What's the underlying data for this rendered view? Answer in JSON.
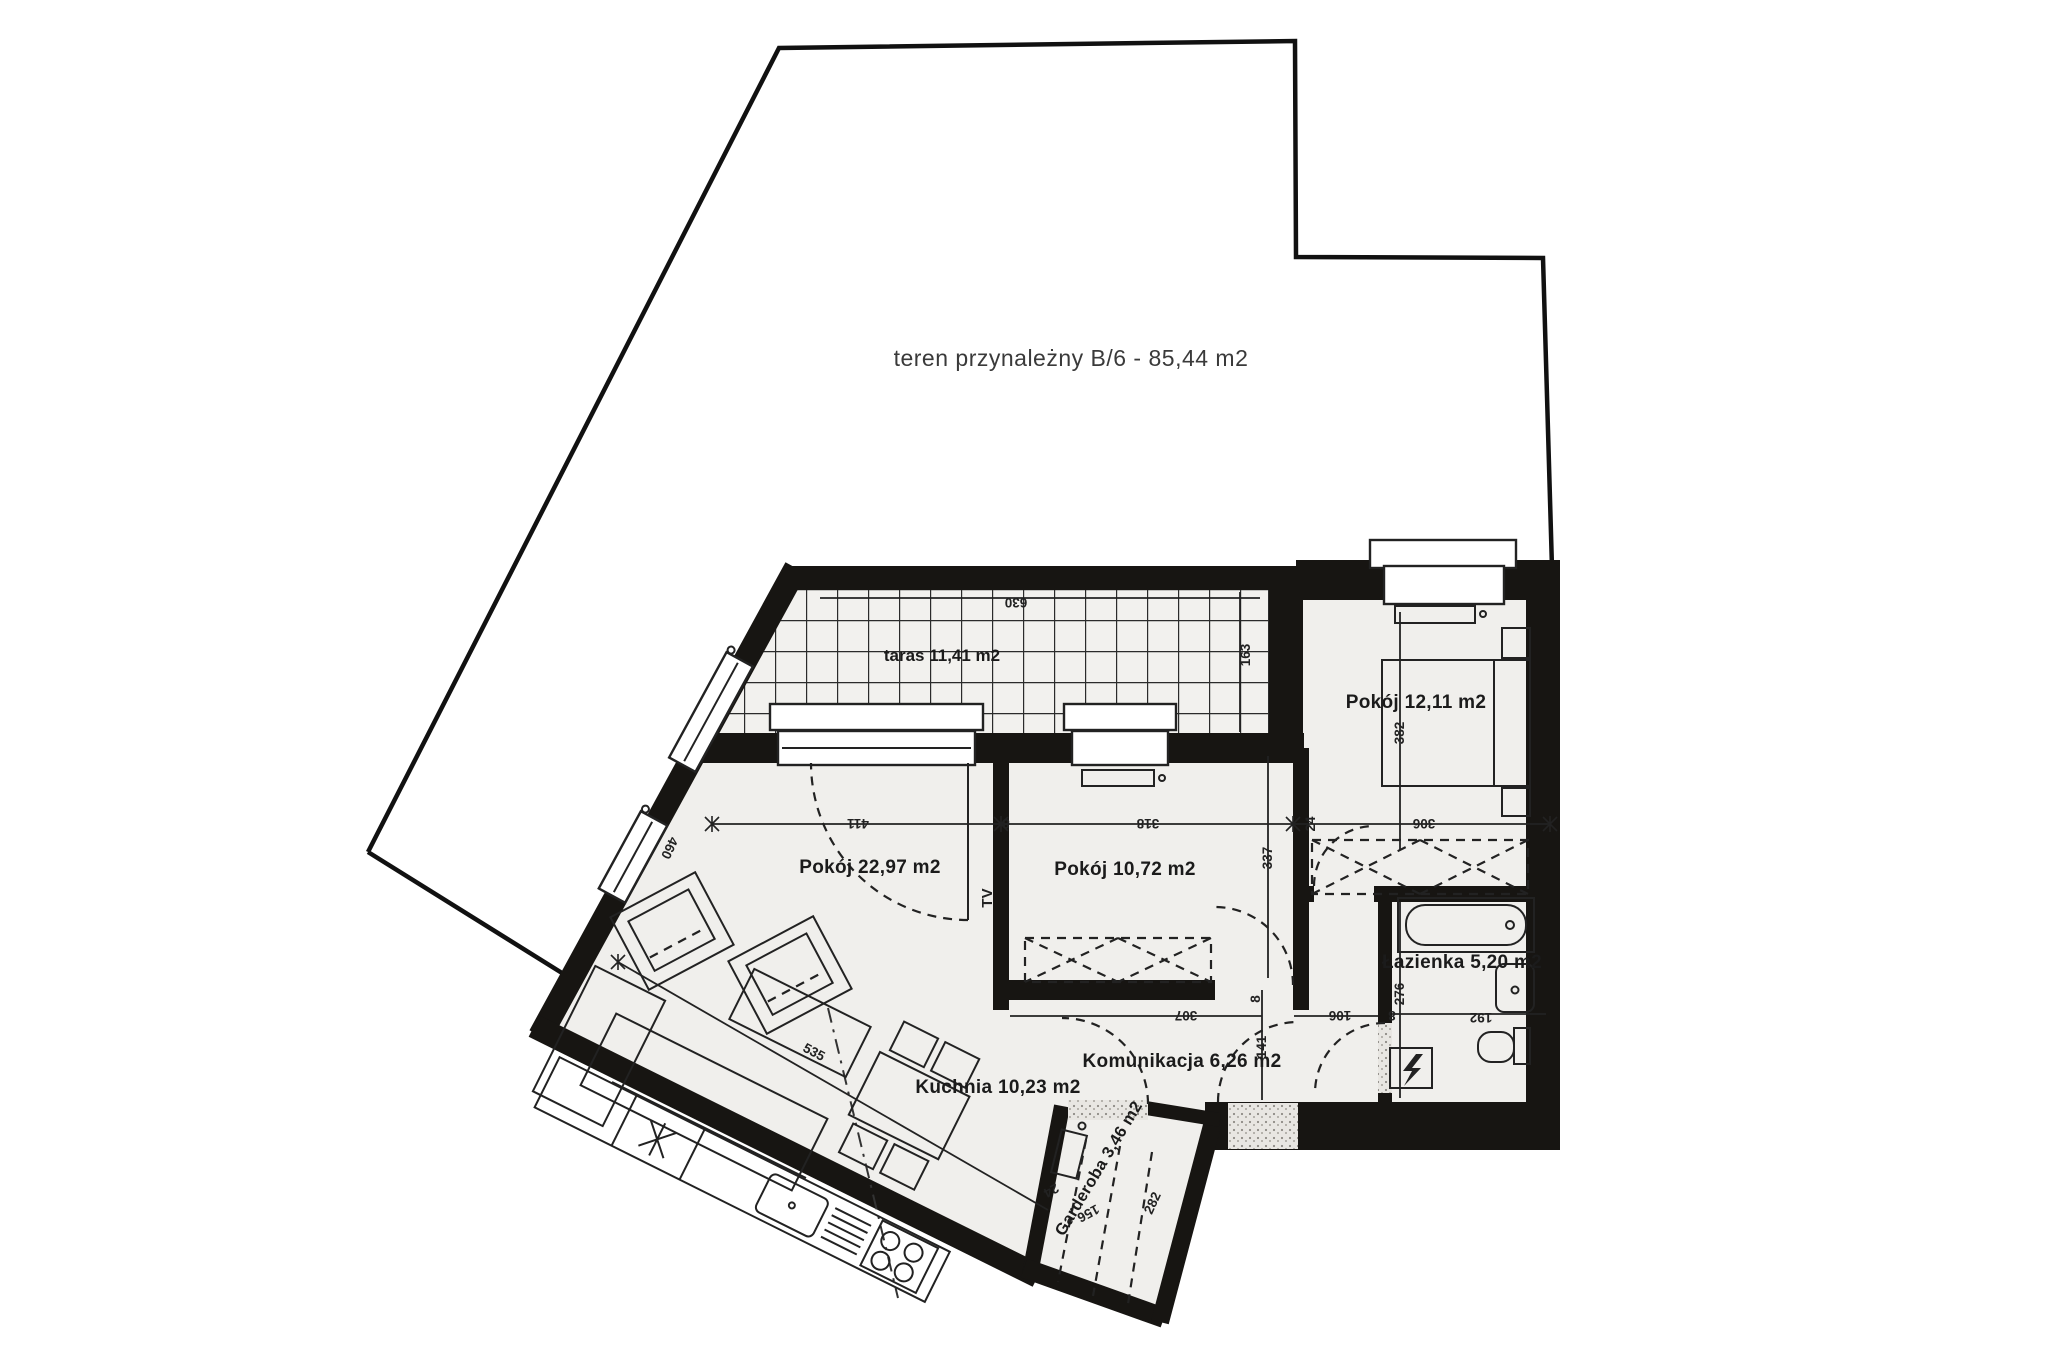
{
  "plan": {
    "terrain_label": "teren przynależny B/6 - 85,44 m2",
    "rooms": {
      "taras": "taras 11,41 m2",
      "pokoj_a": "Pokój 22,97 m2",
      "pokoj_b": "Pokój 10,72 m2",
      "pokoj_c": "Pokój 12,11 m2",
      "lazienka": "Łazienka 5,20 m2",
      "komunikacja": "Komunikacja 6,26 m2",
      "kuchnia": "Kuchnia 10,23 m2",
      "garderoba": "Garderoba 3,46 m2"
    },
    "annotations": {
      "tv": "TV"
    },
    "dims": {
      "d630": "630",
      "d163": "163",
      "d411": "411",
      "d8_wall1": "8",
      "d318": "318",
      "d24_wall": "24",
      "d306": "306",
      "d337": "337",
      "d382": "382",
      "d460": "460",
      "d535": "535",
      "d307": "307",
      "d141": "141",
      "d106": "106",
      "d8_wall2": "8",
      "d8_wall3": "8",
      "d276": "276",
      "d192": "192",
      "d24_gard": "24",
      "d156": "156",
      "d282": "282"
    },
    "colors": {
      "wall": "#171512",
      "floor": "#f0efec",
      "paper": "#ffffff",
      "line": "#222222"
    }
  }
}
